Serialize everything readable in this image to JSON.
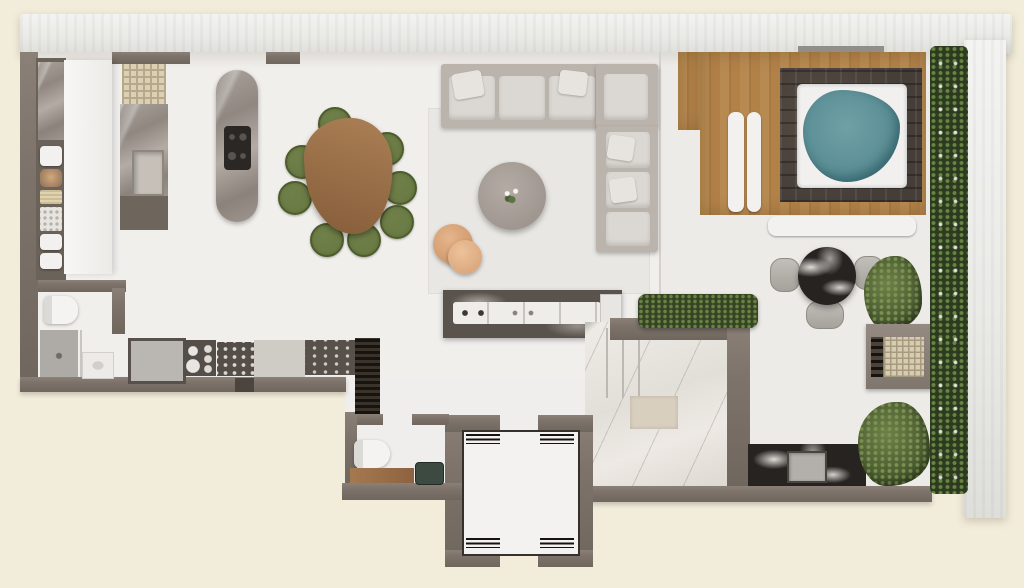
{
  "meta": {
    "scene": "Top-down 3D architectural rendering of a penthouse floor plan with interior rooms, private elevator, and a large terrace with jacuzzi",
    "visible_text": "none",
    "image_size": {
      "width_px": 1024,
      "height_px": 588
    }
  },
  "palette": {
    "background": "#f2ecda",
    "exterior_wall": "#ebebe8",
    "interior_wall": "#7d736a",
    "interior_floor": "#f1efec",
    "terrace_floor": "#edebe7",
    "marble_gray": "#9d958e",
    "marble_white": "#e8e5e0",
    "marble_black": "#272321",
    "wood_table": "#9c744e",
    "wood_deck": "#b1834c",
    "chair_green": "#66753f",
    "water_teal": "#5d9097",
    "plant_green": "#4c5e33",
    "sofa_gray": "#dbd8d3",
    "accent_tan": "#d69f74"
  },
  "zones": [
    {
      "name": "kitchen"
    },
    {
      "name": "dining-area"
    },
    {
      "name": "living-room"
    },
    {
      "name": "bathroom"
    },
    {
      "name": "powder-room"
    },
    {
      "name": "elevator-shaft"
    },
    {
      "name": "terrace"
    },
    {
      "name": "spa-deck"
    },
    {
      "name": "outdoor-kitchen"
    },
    {
      "name": "exterior-stairs"
    }
  ],
  "furniture": [
    "pantry-shelves",
    "kitchen-counter",
    "kitchen-island",
    "cooktop",
    "dining-table",
    "dining-chairs",
    "sectional-sofa",
    "coffee-table",
    "side-tables",
    "bar-counter",
    "refrigerator",
    "plate-rack",
    "spice-rack",
    "wine-rack",
    "wine-cabinet",
    "toilet",
    "shower",
    "vanity-sink",
    "wood-bench",
    "stone-sink",
    "elevator-car",
    "jacuzzi",
    "wood-deck",
    "loungers",
    "outdoor-bench",
    "bistro-table",
    "bistro-chairs",
    "bbq-grill",
    "outdoor-bar",
    "planter-hedge",
    "potted-plants",
    "vertical-garden",
    "marble-stairs"
  ],
  "counts": {
    "dining_chairs": 8,
    "bistro_chairs": 3,
    "sofa_cushions": 8,
    "elevator_rails": 4
  }
}
